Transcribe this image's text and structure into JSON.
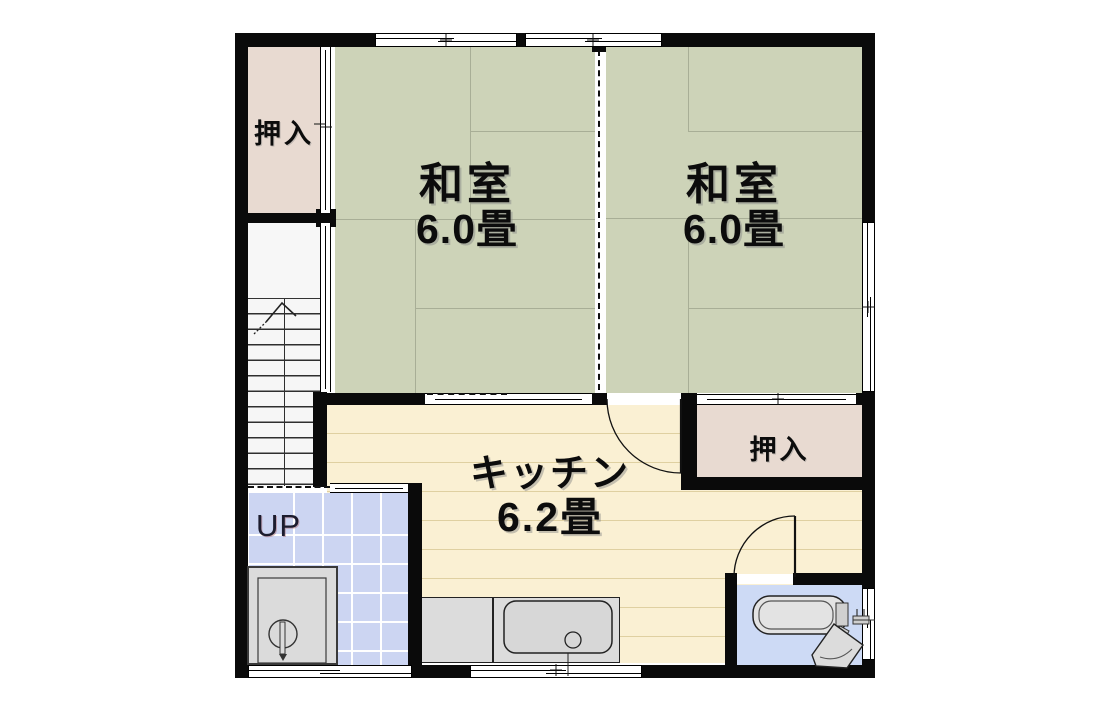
{
  "plan": {
    "rooms": {
      "washitsu_left": {
        "name": "和室",
        "size": "6.0畳"
      },
      "washitsu_right": {
        "name": "和室",
        "size": "6.0畳"
      },
      "kitchen": {
        "name": "キッチン",
        "size": "6.2畳"
      },
      "closet_upper": {
        "name": "押入"
      },
      "closet_middle": {
        "name": "押入"
      },
      "stairs": {
        "direction_label": "UP"
      }
    },
    "colors": {
      "wall": "#0a0a0a",
      "tatami": "#cdd3b8",
      "tatamiline": "#a8ae96",
      "closet": "#e8dad1",
      "kitchen": "#faf0d3",
      "kitchenline": "rgba(190,168,100,0.45)",
      "tile": "#ccd5f2",
      "bath": "#cddaf5",
      "counter": "#dcdcdc"
    }
  }
}
